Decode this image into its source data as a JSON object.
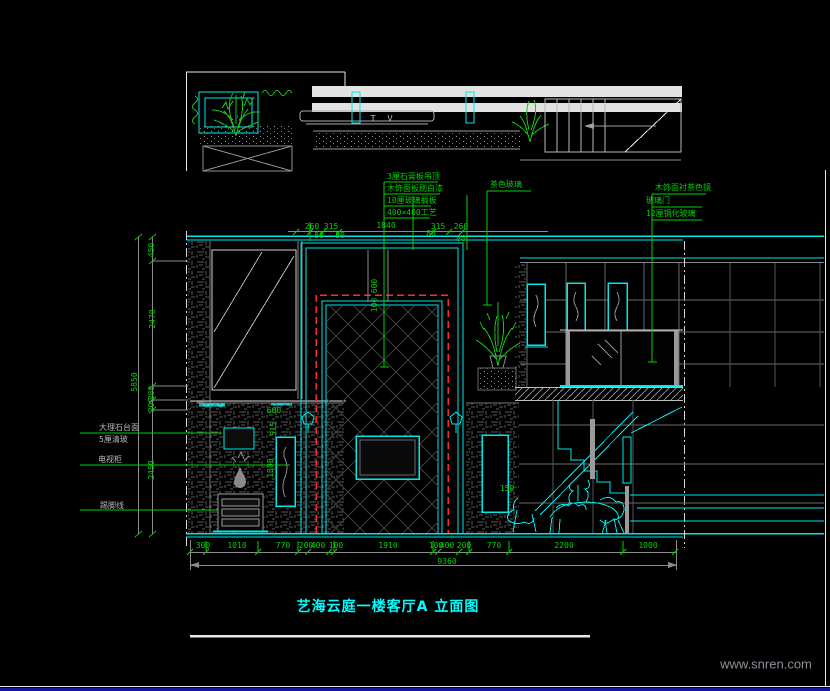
{
  "drawing": {
    "title": "艺海云庭一楼客厅A 立面图",
    "watermark": "www.snren.com",
    "plan_tv_label": "T V"
  },
  "annotations": {
    "ceiling_stack": [
      "3厘石膏板吊顶",
      "木饰面板刷白漆",
      "10厘玻璃搁板",
      "400×400工艺"
    ],
    "mid_leader": "茶色玻璃",
    "right_stack": [
      "木饰面衬茶色镜",
      "玻璃门",
      "12厘钢化玻璃"
    ],
    "left_labels": [
      "大理石台面",
      "5厘清玻",
      "电视柜",
      "踢脚线"
    ]
  },
  "dims": {
    "top": [
      "260",
      "315",
      "80",
      "80",
      "1840",
      "80",
      "315",
      "260",
      "80"
    ],
    "left": [
      "450",
      "2470",
      "280",
      "200",
      "2450"
    ],
    "left_overall": "5850",
    "bottom": [
      "300",
      "1010",
      "770",
      "200",
      "400",
      "100",
      "1910",
      "100",
      "400",
      "200",
      "770",
      "2200",
      "1000"
    ],
    "bottom_overall": "9360",
    "panel_height": "600",
    "panel_reveal": "100",
    "niche_top": "600",
    "niche_width": "515",
    "niche_height": "1300",
    "step": "150"
  },
  "colors": {
    "background": "#000000",
    "line_cyan": "#00e8e8",
    "line_green": "#00d200",
    "line_white": "#f0f0f0",
    "line_gray": "#8a8a8a",
    "accent_red": "#ff2a2a",
    "title_cyan": "#00ffff",
    "frame_blue": "#15159e"
  }
}
